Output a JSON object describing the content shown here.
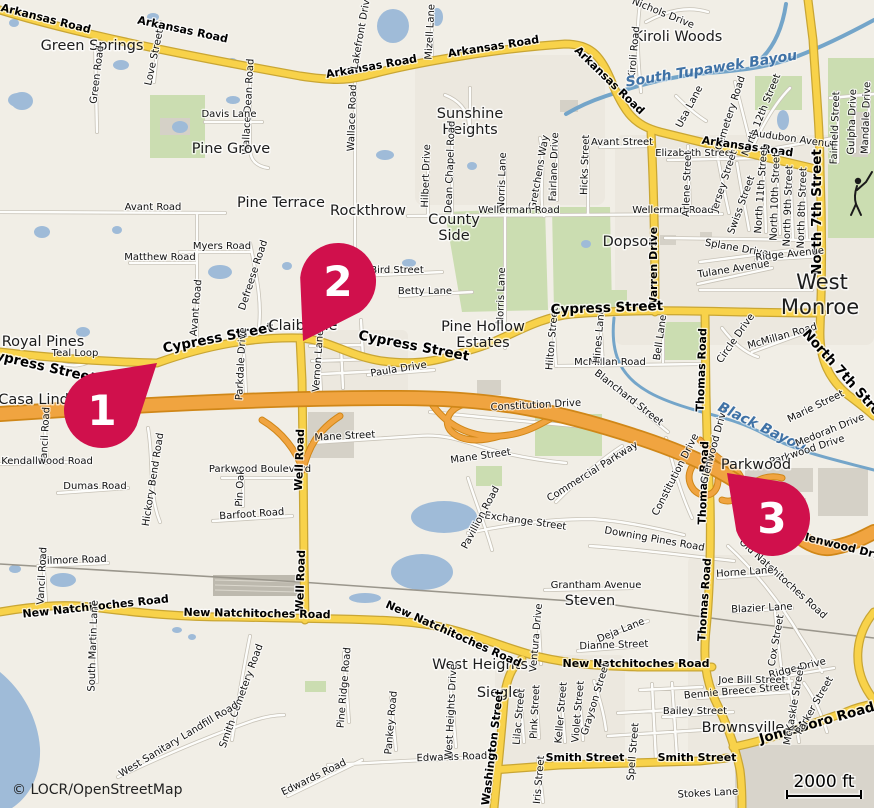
{
  "map": {
    "attribution": "© LOCR/OpenStreetMap",
    "scale": {
      "label": "2000 ft"
    },
    "marker_color": "#D0104C",
    "marker_radius": 38,
    "markers": [
      {
        "label": "1",
        "cx": 102,
        "cy": 410,
        "tx": 157,
        "ty": 363
      },
      {
        "label": "2",
        "cx": 338,
        "cy": 281,
        "tx": 303,
        "ty": 341
      },
      {
        "label": "3",
        "cx": 772,
        "cy": 518,
        "tx": 727,
        "ty": 473
      }
    ],
    "labels": [
      {
        "t": "Arkansas Road",
        "x": 45,
        "y": 22,
        "r": 14,
        "c": "b"
      },
      {
        "t": "Arkansas Road",
        "x": 182,
        "y": 33,
        "r": 12,
        "c": "b"
      },
      {
        "t": "Green Springs",
        "x": 92,
        "y": 50,
        "r": 0,
        "c": "p"
      },
      {
        "t": "Love Street",
        "x": 157,
        "y": 58,
        "r": -78,
        "c": "r"
      },
      {
        "t": "Green Road",
        "x": 100,
        "y": 75,
        "r": -83,
        "c": "r"
      },
      {
        "t": "Wallace Dean Road",
        "x": 251,
        "y": 107,
        "r": -87,
        "c": "r"
      },
      {
        "t": "Davis Lane",
        "x": 229,
        "y": 117,
        "r": 0,
        "c": "r"
      },
      {
        "t": "Pine Grove",
        "x": 231,
        "y": 153,
        "r": 0,
        "c": "p"
      },
      {
        "t": "Arkansas Road",
        "x": 494,
        "y": 50,
        "r": -9,
        "c": "b"
      },
      {
        "t": "Arkansas Road",
        "x": 372,
        "y": 70,
        "r": -10,
        "c": "b"
      },
      {
        "t": "Arkansas Road",
        "x": 607,
        "y": 83,
        "r": 44,
        "c": "b"
      },
      {
        "t": "Lakefront Drive",
        "x": 364,
        "y": 32,
        "r": -80,
        "c": "r"
      },
      {
        "t": "Mizell Lane",
        "x": 433,
        "y": 32,
        "r": -87,
        "c": "r"
      },
      {
        "t": "Wallace Road",
        "x": 355,
        "y": 118,
        "r": -88,
        "c": "r"
      },
      {
        "t": "Sunshine",
        "x": 470,
        "y": 118,
        "r": 0,
        "c": "p"
      },
      {
        "t": "Heights",
        "x": 470,
        "y": 134,
        "r": 0,
        "c": "p"
      },
      {
        "t": "Hilbert Drive",
        "x": 429,
        "y": 176,
        "r": -88,
        "c": "r"
      },
      {
        "t": "Dean Chapel Road",
        "x": 453,
        "y": 167,
        "r": -88,
        "c": "r"
      },
      {
        "t": "Norris Lane",
        "x": 505,
        "y": 181,
        "r": -88,
        "c": "r"
      },
      {
        "t": "Norris Lane",
        "x": 504,
        "y": 296,
        "r": -88,
        "c": "r"
      },
      {
        "t": "Gretchens Way",
        "x": 542,
        "y": 173,
        "r": -80,
        "c": "r"
      },
      {
        "t": "Fairlane Drive",
        "x": 557,
        "y": 167,
        "r": -88,
        "c": "r"
      },
      {
        "t": "Hicks Street",
        "x": 588,
        "y": 165,
        "r": -88,
        "c": "r"
      },
      {
        "t": "Avant Street",
        "x": 622,
        "y": 145,
        "r": 0,
        "c": "r"
      },
      {
        "t": "Wellerman Road",
        "x": 519,
        "y": 213,
        "r": 0,
        "c": "r"
      },
      {
        "t": "Wellerman Road",
        "x": 673,
        "y": 213,
        "r": 0,
        "c": "r"
      },
      {
        "t": "County",
        "x": 454,
        "y": 224,
        "r": 0,
        "c": "p"
      },
      {
        "t": "Side",
        "x": 454,
        "y": 240,
        "r": 0,
        "c": "p"
      },
      {
        "t": "Dopson",
        "x": 630,
        "y": 246,
        "r": 0,
        "c": "p"
      },
      {
        "t": "Warren Drive",
        "x": 657,
        "y": 268,
        "r": -90,
        "c": "b"
      },
      {
        "t": "Nichols Drive",
        "x": 662,
        "y": 16,
        "r": 22,
        "c": "r"
      },
      {
        "t": "Kiroli Woods",
        "x": 678,
        "y": 41,
        "r": 0,
        "c": "p"
      },
      {
        "t": "Kiroli Road",
        "x": 637,
        "y": 53,
        "r": -85,
        "c": "r"
      },
      {
        "t": "South Tupawek Bayou",
        "x": 712,
        "y": 73,
        "r": -9,
        "c": "w"
      },
      {
        "t": "Usa Lane",
        "x": 692,
        "y": 108,
        "r": -62,
        "c": "r"
      },
      {
        "t": "Cemetery Road",
        "x": 733,
        "y": 114,
        "r": -72,
        "c": "r"
      },
      {
        "t": "North 12th Street",
        "x": 764,
        "y": 116,
        "r": -68,
        "c": "r"
      },
      {
        "t": "Audubon Avenue",
        "x": 794,
        "y": 142,
        "r": 8,
        "c": "r"
      },
      {
        "t": "Elizabeth Street",
        "x": 695,
        "y": 156,
        "r": 0,
        "c": "r"
      },
      {
        "t": "Arkansas Road",
        "x": 747,
        "y": 150,
        "r": 8,
        "c": "b"
      },
      {
        "t": "Fairfield Street",
        "x": 838,
        "y": 128,
        "r": -88,
        "c": "r"
      },
      {
        "t": "Gulpha Drive",
        "x": 855,
        "y": 122,
        "r": -88,
        "c": "r"
      },
      {
        "t": "Mandale Drive",
        "x": 869,
        "y": 118,
        "r": -88,
        "c": "r"
      },
      {
        "t": "North 7th Street",
        "x": 821,
        "y": 212,
        "r": -90,
        "c": "B"
      },
      {
        "t": "West",
        "x": 822,
        "y": 289,
        "r": 0,
        "c": "P"
      },
      {
        "t": "Monroe",
        "x": 820,
        "y": 314,
        "r": 0,
        "c": "P"
      },
      {
        "t": "Arlene Street",
        "x": 690,
        "y": 184,
        "r": -88,
        "c": "r"
      },
      {
        "t": "Jersey Street",
        "x": 727,
        "y": 182,
        "r": -72,
        "c": "r"
      },
      {
        "t": "Swiss Street",
        "x": 744,
        "y": 206,
        "r": -70,
        "c": "r"
      },
      {
        "t": "North 11th Street",
        "x": 764,
        "y": 190,
        "r": -86,
        "c": "r"
      },
      {
        "t": "North 10th Street",
        "x": 778,
        "y": 197,
        "r": -88,
        "c": "r"
      },
      {
        "t": "North 9th Street",
        "x": 791,
        "y": 206,
        "r": -88,
        "c": "r"
      },
      {
        "t": "North 8th Street",
        "x": 805,
        "y": 208,
        "r": -88,
        "c": "r"
      },
      {
        "t": "Splane Drive",
        "x": 736,
        "y": 251,
        "r": 10,
        "c": "r"
      },
      {
        "t": "Ridge Avenue",
        "x": 790,
        "y": 257,
        "r": -6,
        "c": "r"
      },
      {
        "t": "Tulane Avenue",
        "x": 734,
        "y": 272,
        "r": -9,
        "c": "r"
      },
      {
        "t": "Bell Lane",
        "x": 663,
        "y": 338,
        "r": -82,
        "c": "r"
      },
      {
        "t": "Circle Drive",
        "x": 738,
        "y": 340,
        "r": -55,
        "c": "r"
      },
      {
        "t": "McMillan Road",
        "x": 783,
        "y": 339,
        "r": -16,
        "c": "r"
      },
      {
        "t": "McMillan Road",
        "x": 610,
        "y": 365,
        "r": 0,
        "c": "r"
      },
      {
        "t": "Hines Lane",
        "x": 602,
        "y": 336,
        "r": -85,
        "c": "r"
      },
      {
        "t": "Hilton Street",
        "x": 555,
        "y": 339,
        "r": -85,
        "c": "r"
      },
      {
        "t": "Betty Lane",
        "x": 425,
        "y": 294,
        "r": 0,
        "c": "r"
      },
      {
        "t": "Bird Street",
        "x": 397,
        "y": 273,
        "r": 0,
        "c": "r"
      },
      {
        "t": "Pine Terrace",
        "x": 281,
        "y": 207,
        "r": 0,
        "c": "p"
      },
      {
        "t": "Rockthrow",
        "x": 368,
        "y": 215,
        "r": 0,
        "c": "p"
      },
      {
        "t": "Myers Road",
        "x": 222,
        "y": 249,
        "r": 0,
        "c": "r"
      },
      {
        "t": "Matthew Road",
        "x": 160,
        "y": 260,
        "r": 0,
        "c": "r"
      },
      {
        "t": "Avant Road",
        "x": 153,
        "y": 210,
        "r": 0,
        "c": "r"
      },
      {
        "t": "Avant Road",
        "x": 199,
        "y": 308,
        "r": -85,
        "c": "r"
      },
      {
        "t": "Defreese Road",
        "x": 256,
        "y": 276,
        "r": -72,
        "c": "r"
      },
      {
        "t": "Royal Pines",
        "x": 43,
        "y": 346,
        "r": 0,
        "c": "p"
      },
      {
        "t": "Teal Loop",
        "x": 75,
        "y": 356,
        "r": 0,
        "c": "r"
      },
      {
        "t": "Cypress Street",
        "x": 40,
        "y": 370,
        "r": 13,
        "c": "B"
      },
      {
        "t": "Cypress Street",
        "x": 219,
        "y": 342,
        "r": -11,
        "c": "B"
      },
      {
        "t": "Claiborne",
        "x": 303,
        "y": 330,
        "r": 0,
        "c": "p"
      },
      {
        "t": "Cypress Street",
        "x": 413,
        "y": 350,
        "r": 11,
        "c": "B"
      },
      {
        "t": "Pine Hollow",
        "x": 483,
        "y": 331,
        "r": 0,
        "c": "p"
      },
      {
        "t": "Estates",
        "x": 483,
        "y": 347,
        "r": 0,
        "c": "p"
      },
      {
        "t": "Cypress Street",
        "x": 607,
        "y": 312,
        "r": -2,
        "c": "B"
      },
      {
        "t": "Vernon Lane",
        "x": 321,
        "y": 361,
        "r": -86,
        "c": "r"
      },
      {
        "t": "Paula Drive",
        "x": 399,
        "y": 372,
        "r": -9,
        "c": "r"
      },
      {
        "t": "Parkdale Drive",
        "x": 244,
        "y": 364,
        "r": -87,
        "c": "r"
      },
      {
        "t": "Casa Linda",
        "x": 38,
        "y": 404,
        "r": 0,
        "c": "p"
      },
      {
        "t": "Vancil Road",
        "x": 48,
        "y": 436,
        "r": -87,
        "c": "r"
      },
      {
        "t": "Kendallwood Road",
        "x": 47,
        "y": 464,
        "r": 0,
        "c": "r"
      },
      {
        "t": "Dumas Road",
        "x": 95,
        "y": 489,
        "r": 0,
        "c": "r"
      },
      {
        "t": "Hickory Bend Road",
        "x": 156,
        "y": 480,
        "r": -81,
        "c": "r"
      },
      {
        "t": "Parkwood Boulevard",
        "x": 260,
        "y": 472,
        "r": 0,
        "c": "r"
      },
      {
        "t": "Pin Oak",
        "x": 243,
        "y": 488,
        "r": -87,
        "c": "r"
      },
      {
        "t": "Barfoot Road",
        "x": 252,
        "y": 517,
        "r": -4,
        "c": "r"
      },
      {
        "t": "Well Road",
        "x": 303,
        "y": 460,
        "r": -88,
        "c": "b"
      },
      {
        "t": "Well Road",
        "x": 304,
        "y": 581,
        "r": -88,
        "c": "b"
      },
      {
        "t": "Mane Street",
        "x": 345,
        "y": 439,
        "r": -3,
        "c": "r"
      },
      {
        "t": "Mane Street",
        "x": 481,
        "y": 459,
        "r": -8,
        "c": "r"
      },
      {
        "t": "Constitution Drive",
        "x": 536,
        "y": 408,
        "r": -3,
        "c": "r"
      },
      {
        "t": "Constitution Drive",
        "x": 678,
        "y": 476,
        "r": -63,
        "c": "r"
      },
      {
        "t": "Commercial Parkway",
        "x": 594,
        "y": 474,
        "r": -32,
        "c": "r"
      },
      {
        "t": "Blanchard Street",
        "x": 627,
        "y": 400,
        "r": 38,
        "c": "r"
      },
      {
        "t": "Thomas Road",
        "x": 705,
        "y": 370,
        "r": -88,
        "c": "b"
      },
      {
        "t": "Thomas Road",
        "x": 707,
        "y": 483,
        "r": -88,
        "c": "b"
      },
      {
        "t": "Thomas Road",
        "x": 708,
        "y": 600,
        "r": -86,
        "c": "b"
      },
      {
        "t": "Glenwood Drive",
        "x": 717,
        "y": 446,
        "r": -75,
        "c": "r"
      },
      {
        "t": "Black Bayou",
        "x": 760,
        "y": 431,
        "r": 26,
        "c": "w",
        "s": 16
      },
      {
        "t": "Marie Street",
        "x": 817,
        "y": 409,
        "r": -26,
        "c": "r"
      },
      {
        "t": "Medorah Drive",
        "x": 831,
        "y": 433,
        "r": -22,
        "c": "r"
      },
      {
        "t": "Parkwood Drive",
        "x": 808,
        "y": 453,
        "r": -18,
        "c": "r"
      },
      {
        "t": "North 7th Street",
        "x": 844,
        "y": 381,
        "r": 48,
        "c": "B"
      },
      {
        "t": "Parkwood",
        "x": 756,
        "y": 469,
        "r": 0,
        "c": "p"
      },
      {
        "t": "Glenwood Drive",
        "x": 843,
        "y": 550,
        "r": 14,
        "c": "b"
      },
      {
        "t": "Old Natchitoches Road",
        "x": 781,
        "y": 581,
        "r": 42,
        "c": "r"
      },
      {
        "t": "Horne Lane",
        "x": 745,
        "y": 575,
        "r": -4,
        "c": "r"
      },
      {
        "t": "Blazier Lane",
        "x": 762,
        "y": 611,
        "r": -3,
        "c": "r"
      },
      {
        "t": "Deja Lane",
        "x": 622,
        "y": 633,
        "r": -22,
        "c": "r"
      },
      {
        "t": "Dianne Street",
        "x": 614,
        "y": 648,
        "r": -2,
        "c": "r"
      },
      {
        "t": "New Natchitoches Road",
        "x": 636,
        "y": 667,
        "r": 0,
        "c": "b"
      },
      {
        "t": "Cox Street",
        "x": 779,
        "y": 641,
        "r": -80,
        "c": "r"
      },
      {
        "t": "Ridge Drive",
        "x": 798,
        "y": 671,
        "r": -14,
        "c": "r"
      },
      {
        "t": "Joe Bill Street",
        "x": 752,
        "y": 683,
        "r": 0,
        "c": "r"
      },
      {
        "t": "Bennie Breece Street",
        "x": 737,
        "y": 694,
        "r": -5,
        "c": "r"
      },
      {
        "t": "Bailey Street",
        "x": 695,
        "y": 714,
        "r": 0,
        "c": "r"
      },
      {
        "t": "Brownsville",
        "x": 743,
        "y": 732,
        "r": 0,
        "c": "p"
      },
      {
        "t": "Jonesboro Road",
        "x": 818,
        "y": 727,
        "r": -16,
        "c": "B"
      },
      {
        "t": "McKaskle Street",
        "x": 797,
        "y": 706,
        "r": -80,
        "c": "r"
      },
      {
        "t": "Parker Street",
        "x": 817,
        "y": 707,
        "r": -60,
        "c": "r"
      },
      {
        "t": "Spell Street",
        "x": 636,
        "y": 752,
        "r": -85,
        "c": "r"
      },
      {
        "t": "Smith Street",
        "x": 585,
        "y": 761,
        "r": 0,
        "c": "b"
      },
      {
        "t": "Smith Street",
        "x": 697,
        "y": 761,
        "r": 0,
        "c": "b"
      },
      {
        "t": "Stokes Lane",
        "x": 708,
        "y": 796,
        "r": -3,
        "c": "r"
      },
      {
        "t": "Edwards Road",
        "x": 452,
        "y": 760,
        "r": -2,
        "c": "r"
      },
      {
        "t": "Edwards Road",
        "x": 315,
        "y": 780,
        "r": -26,
        "c": "r"
      },
      {
        "t": "West Heights",
        "x": 480,
        "y": 669,
        "r": 0,
        "c": "p"
      },
      {
        "t": "Siegle",
        "x": 499,
        "y": 697,
        "r": 0,
        "c": "p"
      },
      {
        "t": "Washington Street",
        "x": 496,
        "y": 748,
        "r": -83,
        "c": "b"
      },
      {
        "t": "Lilac Street",
        "x": 522,
        "y": 717,
        "r": -85,
        "c": "r"
      },
      {
        "t": "Pink Street",
        "x": 538,
        "y": 712,
        "r": -87,
        "c": "r"
      },
      {
        "t": "Keller Street",
        "x": 564,
        "y": 713,
        "r": -85,
        "c": "r"
      },
      {
        "t": "Violet Street",
        "x": 581,
        "y": 712,
        "r": -85,
        "c": "r"
      },
      {
        "t": "Grayson Street",
        "x": 598,
        "y": 700,
        "r": -73,
        "c": "r"
      },
      {
        "t": "Iris Street",
        "x": 542,
        "y": 780,
        "r": -85,
        "c": "r"
      },
      {
        "t": "Ventura Drive",
        "x": 539,
        "y": 638,
        "r": -85,
        "c": "r"
      },
      {
        "t": "West Heights Drive",
        "x": 454,
        "y": 712,
        "r": -87,
        "c": "r"
      },
      {
        "t": "Pine Ridge Road",
        "x": 347,
        "y": 688,
        "r": -85,
        "c": "r"
      },
      {
        "t": "Pankey Road",
        "x": 394,
        "y": 723,
        "r": -85,
        "c": "r"
      },
      {
        "t": "Grantham Avenue",
        "x": 596,
        "y": 588,
        "r": 0,
        "c": "r"
      },
      {
        "t": "Steven",
        "x": 590,
        "y": 605,
        "r": 0,
        "c": "p"
      },
      {
        "t": "Downing Pines Road",
        "x": 654,
        "y": 542,
        "r": 10,
        "c": "r"
      },
      {
        "t": "Exchange Street",
        "x": 525,
        "y": 524,
        "r": 8,
        "c": "r"
      },
      {
        "t": "Pavillion Road",
        "x": 483,
        "y": 519,
        "r": -62,
        "c": "r"
      },
      {
        "t": "Gilmore Road",
        "x": 73,
        "y": 563,
        "r": -2,
        "c": "r"
      },
      {
        "t": "Vancil Road",
        "x": 45,
        "y": 576,
        "r": -87,
        "c": "r"
      },
      {
        "t": "New Natchitoches Road",
        "x": 96,
        "y": 610,
        "r": -6,
        "c": "b"
      },
      {
        "t": "New Natchitoches Road",
        "x": 257,
        "y": 617,
        "r": 1,
        "c": "b"
      },
      {
        "t": "New Natchitoches Road",
        "x": 452,
        "y": 637,
        "r": 24,
        "c": "b"
      },
      {
        "t": "South Martin Lane",
        "x": 96,
        "y": 646,
        "r": -88,
        "c": "r"
      },
      {
        "t": "Smith Cemetery Road",
        "x": 244,
        "y": 697,
        "r": -70,
        "c": "r"
      },
      {
        "t": "West Sanitary Landfill Road",
        "x": 180,
        "y": 742,
        "r": -31,
        "c": "r"
      }
    ]
  }
}
